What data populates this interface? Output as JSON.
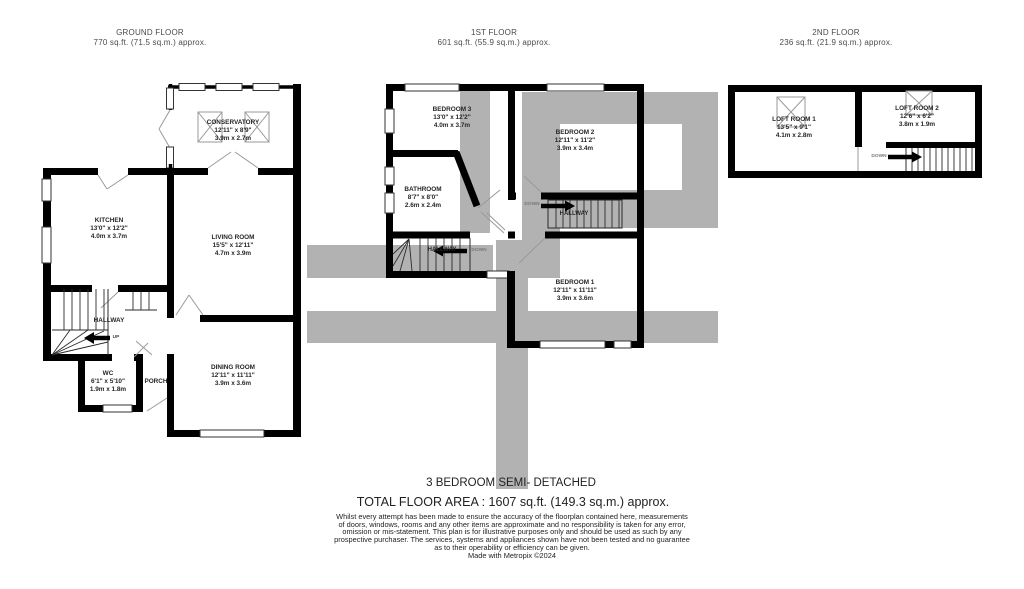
{
  "headers": {
    "ground": {
      "title": "GROUND FLOOR",
      "area": "770 sq.ft. (71.5 sq.m.) approx."
    },
    "first": {
      "title": "1ST FLOOR",
      "area": "601 sq.ft. (55.9 sq.m.) approx."
    },
    "second": {
      "title": "2ND FLOOR",
      "area": "236 sq.ft. (21.9 sq.m.) approx."
    }
  },
  "floors": {
    "ground": {
      "rooms": [
        {
          "name": "CONSERVATORY",
          "imperial": "12'11\" x 8'9\"",
          "metric": "3.9m x 2.7m"
        },
        {
          "name": "KITCHEN",
          "imperial": "13'0\" x 12'2\"",
          "metric": "4.0m x 3.7m"
        },
        {
          "name": "LIVING ROOM",
          "imperial": "15'5\" x 12'11\"",
          "metric": "4.7m x 3.9m"
        },
        {
          "name": "HALLWAY"
        },
        {
          "name": "WC",
          "imperial": "6'1\" x 5'10\"",
          "metric": "1.9m x 1.8m"
        },
        {
          "name": "PORCH"
        },
        {
          "name": "DINING ROOM",
          "imperial": "12'11\" x 11'11\"",
          "metric": "3.9m x 3.6m"
        }
      ]
    },
    "first": {
      "rooms": [
        {
          "name": "BEDROOM 3",
          "imperial": "13'0\" x 12'2\"",
          "metric": "4.0m x 3.7m"
        },
        {
          "name": "BATHROOM",
          "imperial": "8'7\" x 8'0\"",
          "metric": "2.6m x 2.4m"
        },
        {
          "name": "HALLWAY"
        },
        {
          "name": "BEDROOM 2",
          "imperial": "12'11\" x 11'2\"",
          "metric": "3.9m x 3.4m"
        },
        {
          "name": "HALLWAY"
        },
        {
          "name": "BEDROOM 1",
          "imperial": "12'11\" x 11'11\"",
          "metric": "3.9m x 3.6m"
        }
      ]
    },
    "second": {
      "rooms": [
        {
          "name": "LOFT ROOM 1",
          "imperial": "13'5\" x 9'1\"",
          "metric": "4.1m x 2.8m"
        },
        {
          "name": "LOFT ROOM 2",
          "imperial": "12'6\" x 6'2\"",
          "metric": "3.8m x 1.9m"
        }
      ]
    }
  },
  "stair_labels": {
    "ground_up": "UP",
    "first_left_down": "DOWN",
    "first_right_down": "DOWN",
    "second_down": "DOWN"
  },
  "icons": {
    "roof_window": "roof-window-icon (rectangle with X)",
    "ground_up_arrow": "left-pointing stairs arrow",
    "first_left_down_arrow": "left-pointing stairs arrow",
    "first_right_down_arrow": "right-pointing stairs arrow",
    "second_down_arrow": "right-pointing stairs arrow"
  },
  "colors": {
    "wall": "#000000",
    "watermark_gray": "#b2b2b2",
    "background": "#ffffff"
  },
  "footer": {
    "property_type": "3 BEDROOM SEMI- DETACHED",
    "total_area": "TOTAL FLOOR AREA : 1607 sq.ft. (149.3 sq.m.) approx.",
    "disclaimer_lines": [
      "Whilst every attempt has been made to ensure the accuracy of the floorplan contained here, measurements",
      "of doors, windows, rooms and any other items are approximate and no responsibility is taken for any error,",
      "omission or mis-statement. This plan is for illustrative purposes only and should be used as such by any",
      "prospective purchaser. The services, systems and appliances shown have not been tested and no guarantee",
      "as to their operability or efficiency can be given."
    ],
    "credit": "Made with Metropix ©2024"
  }
}
